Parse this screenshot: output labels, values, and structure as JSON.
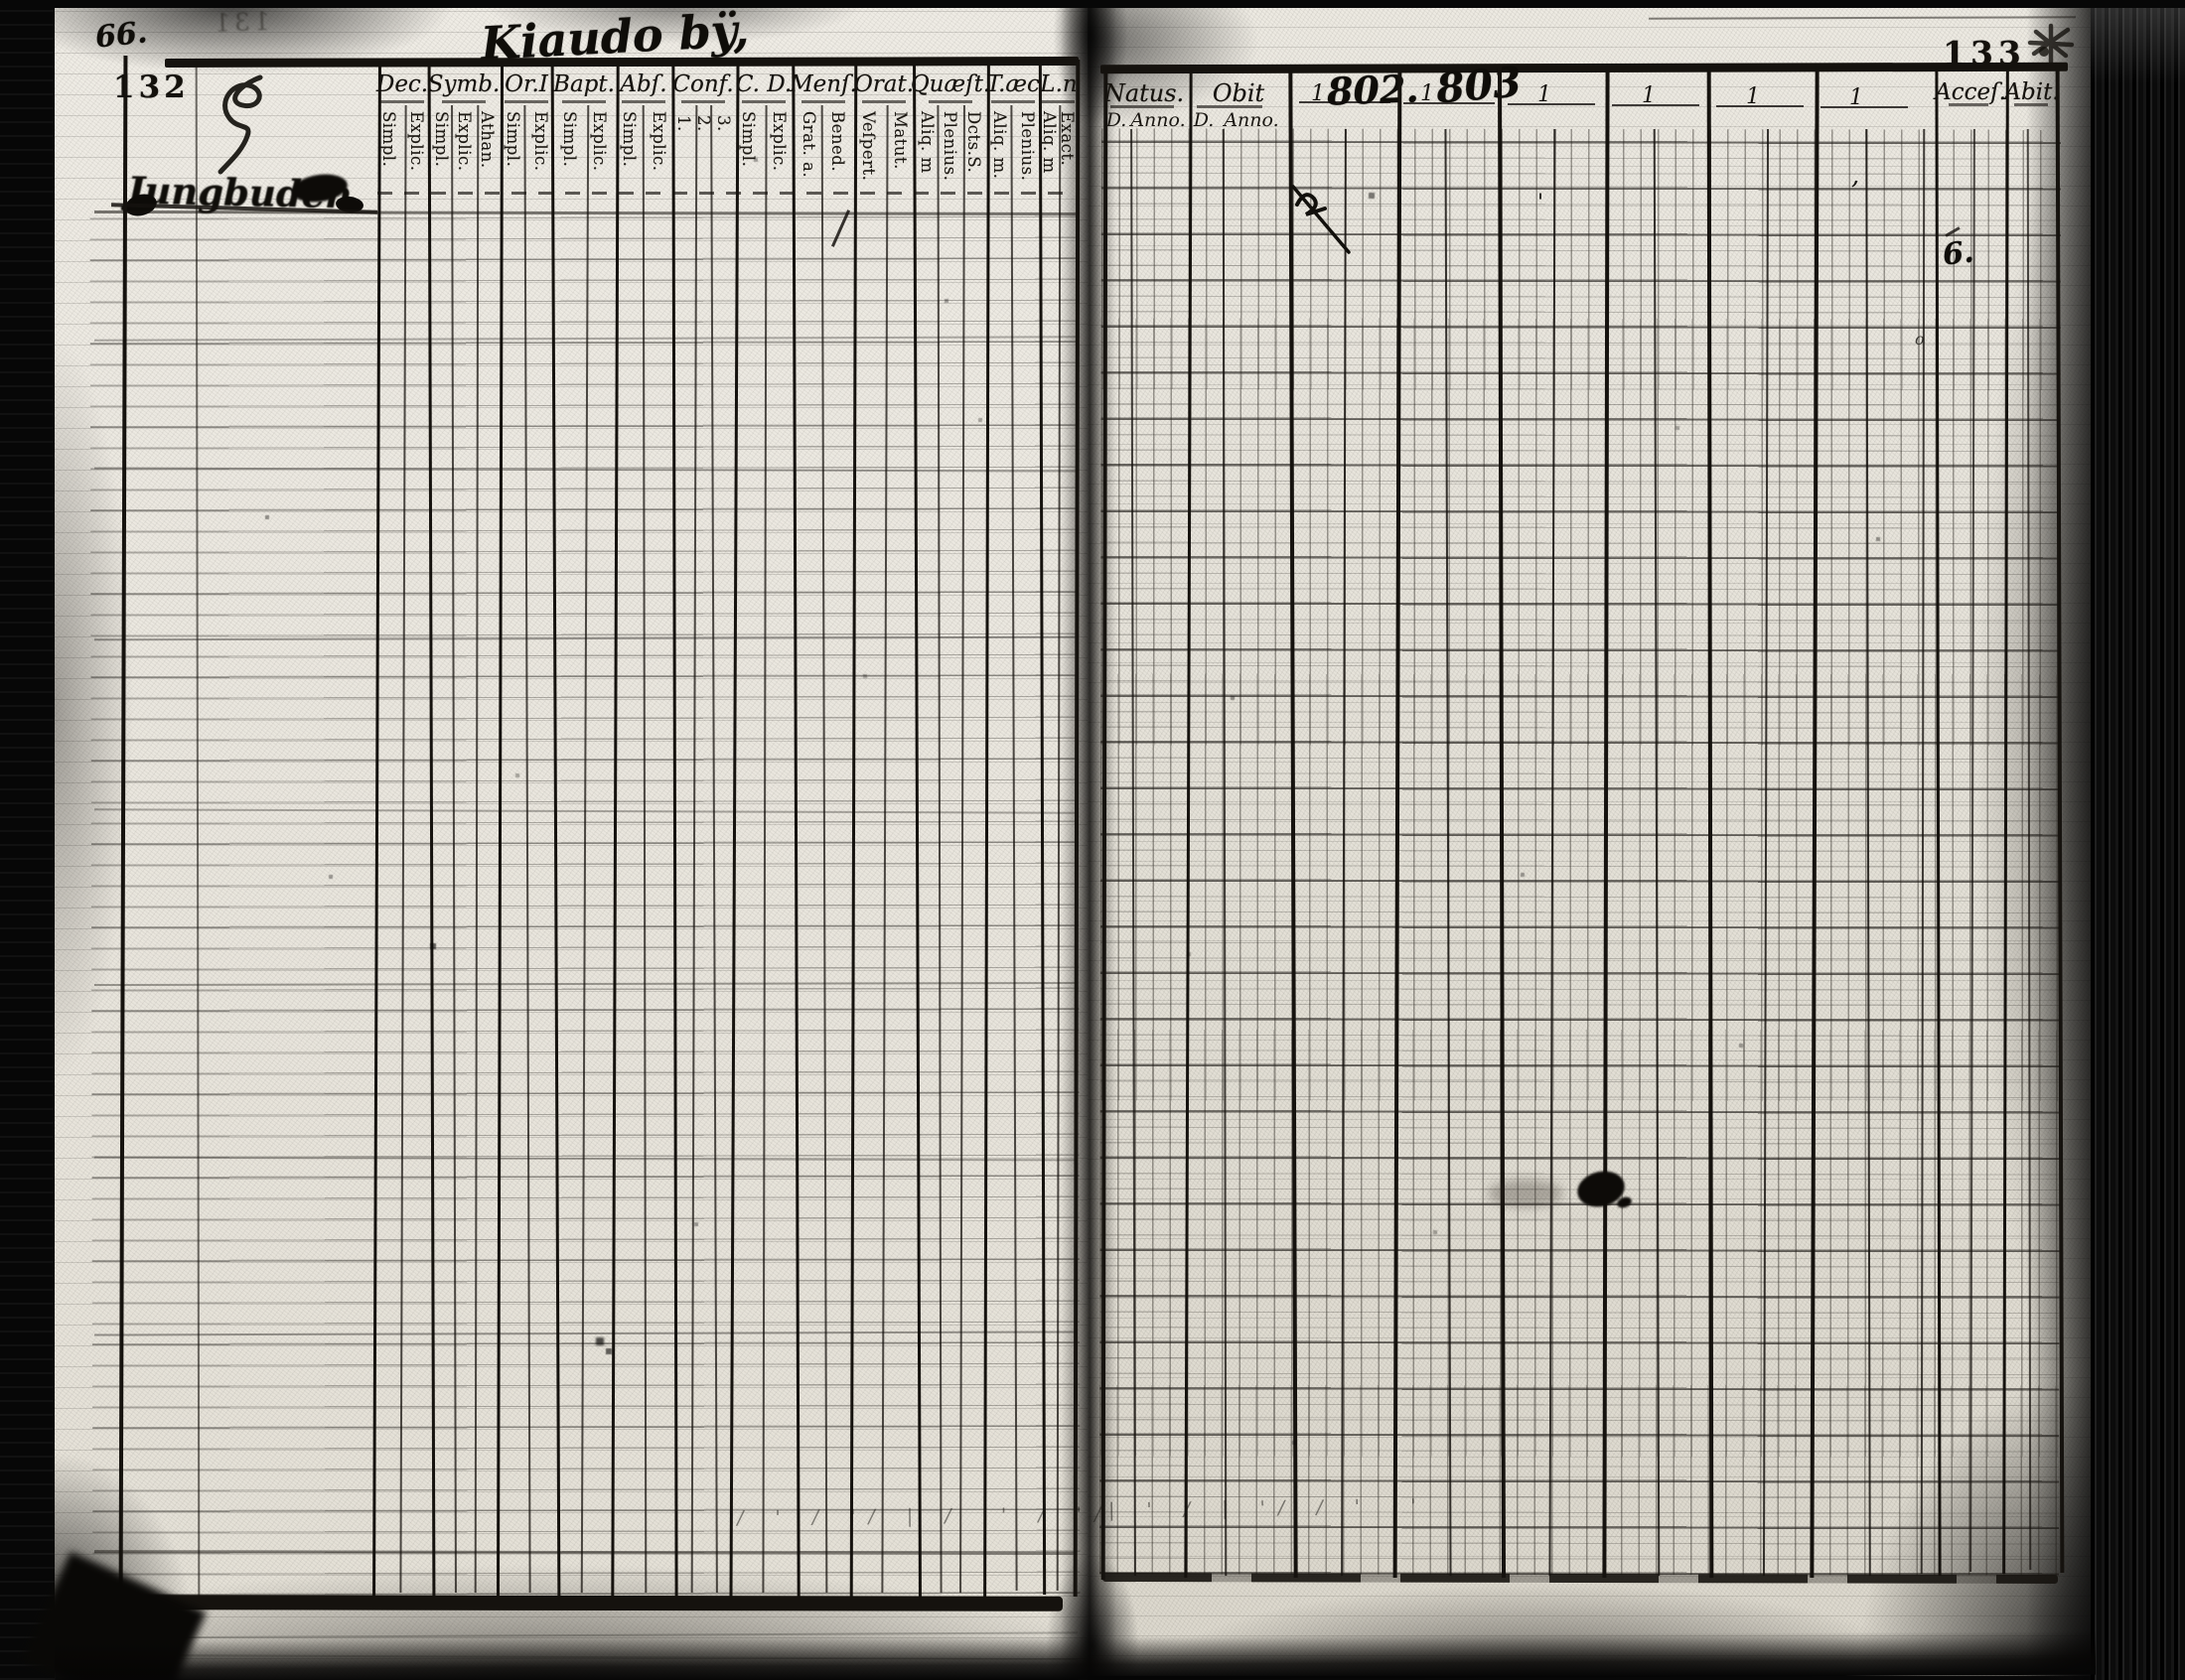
{
  "page": {
    "folio_left": "132",
    "folio_right": "133",
    "ghost_folio": "131",
    "corner_annotation": "66.",
    "title_handwritten": "Kiaudo bÿ,",
    "name_scribble": "Jungbuden"
  },
  "left_table": {
    "columns": [
      {
        "label": "Dec.",
        "subs": [
          "Simpl.",
          "Explic."
        ]
      },
      {
        "label": "Symb.",
        "subs": [
          "Simpl.",
          "Explic.",
          "Athan."
        ]
      },
      {
        "label": "Or.I",
        "subs": [
          "Simpl.",
          "Explic."
        ]
      },
      {
        "label": "Bapt.",
        "subs": [
          "Simpl.",
          "Explic."
        ]
      },
      {
        "label": "Abſ.",
        "subs": [
          "Simpl.",
          "Explic."
        ]
      },
      {
        "label": "Conf.",
        "subs": [
          "1.",
          "2.",
          "3."
        ]
      },
      {
        "label": "C. D.",
        "subs": [
          "Simpl.",
          "Explic."
        ]
      },
      {
        "label": "Menſ.",
        "subs": [
          "Grat. a.",
          "Bened."
        ]
      },
      {
        "label": "Orat.",
        "subs": [
          "Veſpert.",
          "Matut."
        ]
      },
      {
        "label": "Quæſt.",
        "subs": [
          "Aliq. m",
          "Plenius.",
          "Dcts.S."
        ]
      },
      {
        "label": "T.æc",
        "subs": [
          "Aliq. m.",
          "Plenius."
        ]
      },
      {
        "label": "L.n",
        "subs": [
          "Aliq. m",
          "Exact."
        ]
      }
    ]
  },
  "right_table": {
    "columns": [
      {
        "label": "Natus.",
        "subs": [
          "D.",
          "Anno."
        ]
      },
      {
        "label": "Obit",
        "subs": [
          "D.",
          "Anno."
        ]
      }
    ],
    "year_columns": [
      {
        "printed": "1",
        "handwritten": "802."
      },
      {
        "printed": "1",
        "handwritten": "803"
      },
      {
        "printed": "1"
      },
      {
        "printed": "1"
      },
      {
        "printed": "1"
      },
      {
        "printed": "1"
      }
    ],
    "end_columns": [
      {
        "label": "Acceſ."
      },
      {
        "label": "Abit."
      }
    ]
  },
  "annotations": {
    "acces_mark": "6.",
    "acces_small_mark": "o",
    "year3_tick": "'",
    "year6_tick": ",",
    "orat_slash": "/",
    "left_tallies": "/ ' / '/ | / '' / '/",
    "right_tallies": "| ' / | '/ / ' |'"
  }
}
